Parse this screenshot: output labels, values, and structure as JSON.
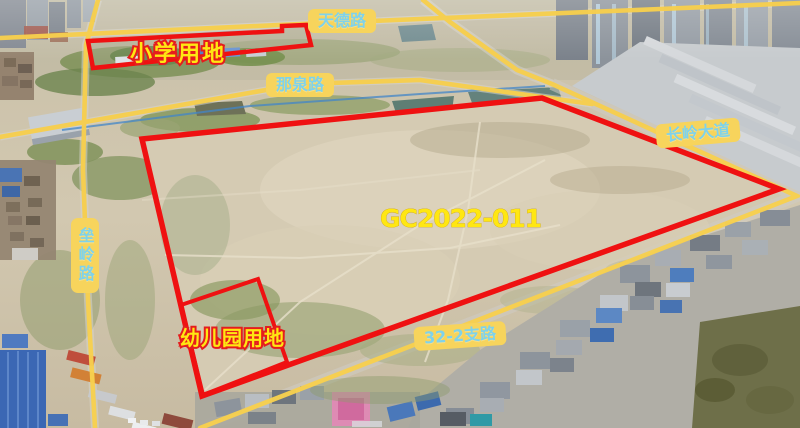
{
  "annotations": {
    "parcel_id": "GC2022-011",
    "plots": {
      "school": "小学用地",
      "kindergarten": "幼儿园用地"
    },
    "roads": {
      "tiande": "天德路",
      "naquan": "那泉路",
      "changling": "长岭大道",
      "leiling": "垒岭路",
      "branch_32_2": "32-2支路"
    },
    "colors": {
      "boundary_red": "#ef1111",
      "road_line_yellow": "#f7cf4e",
      "label_background_yellow": "#f7d45c",
      "label_text_blue": "#7fd2ea",
      "plot_text_yellow": "#ffe712"
    }
  }
}
